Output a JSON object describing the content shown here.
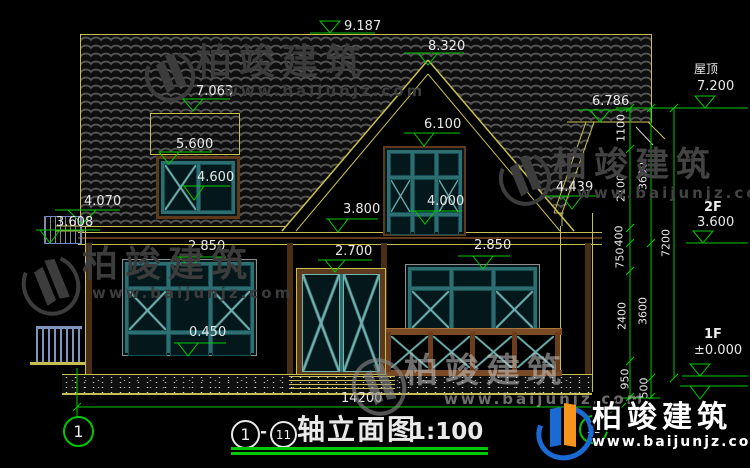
{
  "title": {
    "axis_start": "1",
    "dash": "-",
    "axis_end": "11",
    "name": "轴立面图",
    "scale": "1:100"
  },
  "axis": {
    "left_bubble": "1",
    "right_bubble": "11"
  },
  "levels": {
    "ridge": "9.187",
    "gable_peak": "8.320",
    "dormer_top": "7.063",
    "dormer_win_top": "5.600",
    "dormer_sill": "4.600",
    "left_eave": "4.070",
    "left_ledge": "3.608",
    "gable_window_top": "6.100",
    "gable_window_sill": "4.000",
    "floor2_line": "3.800",
    "window_left_top": "2.850",
    "door_top": "2.700",
    "window_right_top": "2.850",
    "window_left_sill": "0.450",
    "right_barge": "4.439",
    "right_eave": "6.786"
  },
  "grades": {
    "roof_label": "屋顶",
    "roof_value": "7.200",
    "f2_label": "2F",
    "f2_value": "3.600",
    "f1_label": "1F",
    "f1_value": "±0.000"
  },
  "dimensions": {
    "chain_a": [
      "1100",
      "2100",
      "400",
      "750",
      "2400",
      "950"
    ],
    "chain_b": [
      "3600",
      "3600",
      "500"
    ],
    "chain_c": [
      "7200"
    ],
    "total_width": "14200"
  },
  "watermark": {
    "brand": "柏竣建筑",
    "url": "www.baijunjz.com"
  },
  "colors": {
    "dimension_green": "#00c800",
    "line_yellow": "#c8bf50",
    "frame_teal": "#2f6e70",
    "wood_brown": "#7a4a24"
  }
}
